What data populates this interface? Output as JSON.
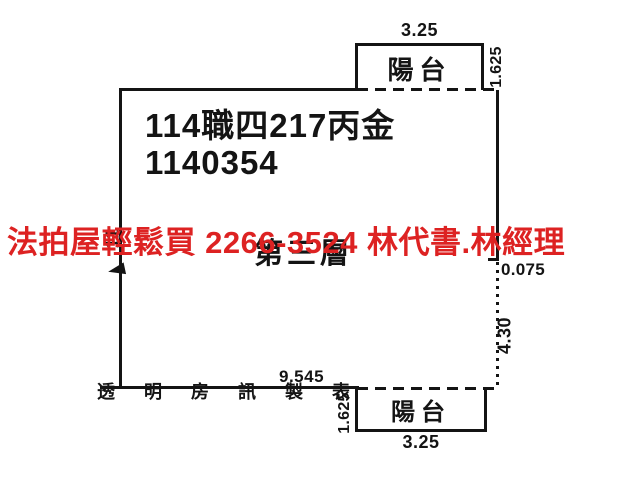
{
  "colors": {
    "background": "#ffffff",
    "line": "#141414",
    "text": "#141414",
    "ad_red": "#dd2222"
  },
  "title_block": {
    "case_number": "114職四217丙金",
    "file_number": "1140354"
  },
  "floor_label": "第三層",
  "ad_overlay": {
    "text": "法拍屋輕鬆買  2266-3524  林代書.林經理"
  },
  "watermark": "透 明 房 訊 製 表",
  "balconies": {
    "top": {
      "label": "陽台",
      "width": "3.25",
      "depth": "1.625"
    },
    "bottom": {
      "label": "陽台",
      "width": "3.25",
      "depth": "1.625"
    }
  },
  "dimensions": {
    "bottom_width": "9.545",
    "right_offset": "0.075",
    "right_height": "4.30",
    "left_height": "11"
  }
}
